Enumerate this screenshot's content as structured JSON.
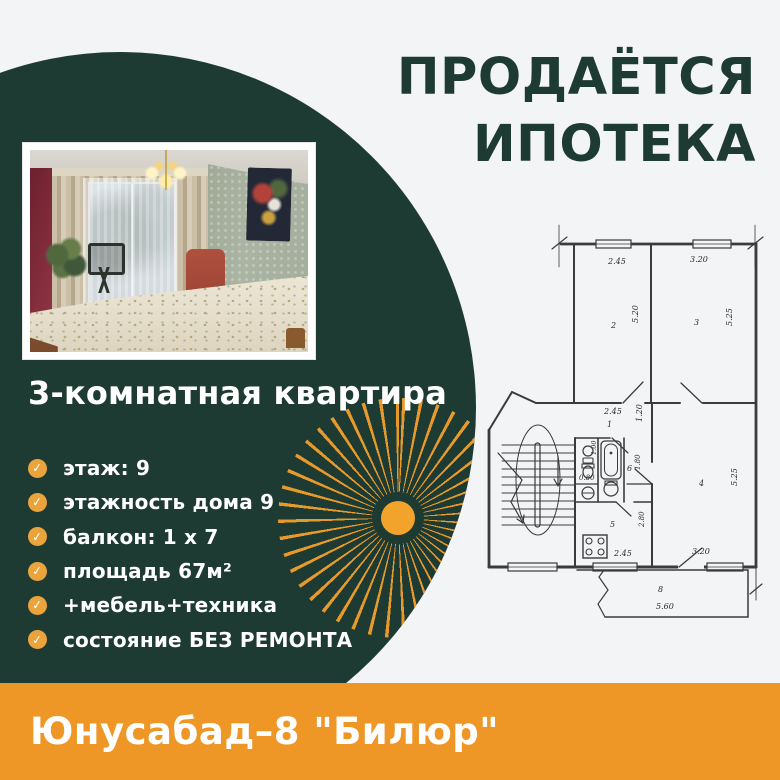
{
  "colors": {
    "green": "#1d3b32",
    "footer_orange": "#ee9726",
    "bullet_orange": "#eba43c",
    "sun_orange": "#f2a32c",
    "ray_orange": "#e8992b",
    "background": "#f3f4f6",
    "plan_line": "#3b3b3b"
  },
  "title": {
    "line1": "ПРОДАЁТСЯ",
    "line2": "ИПОТЕКА"
  },
  "listing": {
    "heading": "3-комнатная квартира",
    "features": [
      "этаж: 9",
      "этажность дома 9",
      "балкон: 1 х 7",
      "площадь 67м²",
      "+мебель+техника",
      "состояние БЕЗ РЕМОНТА"
    ]
  },
  "icons": {
    "check": "✓"
  },
  "footer": {
    "location": "Юнусабад–8 \"Билюр\""
  },
  "floorplan": {
    "labels": [
      "2.45",
      "3.20",
      "2",
      "5.20",
      "3",
      "5.25",
      "2.45",
      "1",
      "1.20",
      "1.00",
      "0.80",
      "6",
      "1.80",
      "5",
      "2.45",
      "2.80",
      "4",
      "5.25",
      "3.20",
      "8",
      "5.60"
    ]
  }
}
